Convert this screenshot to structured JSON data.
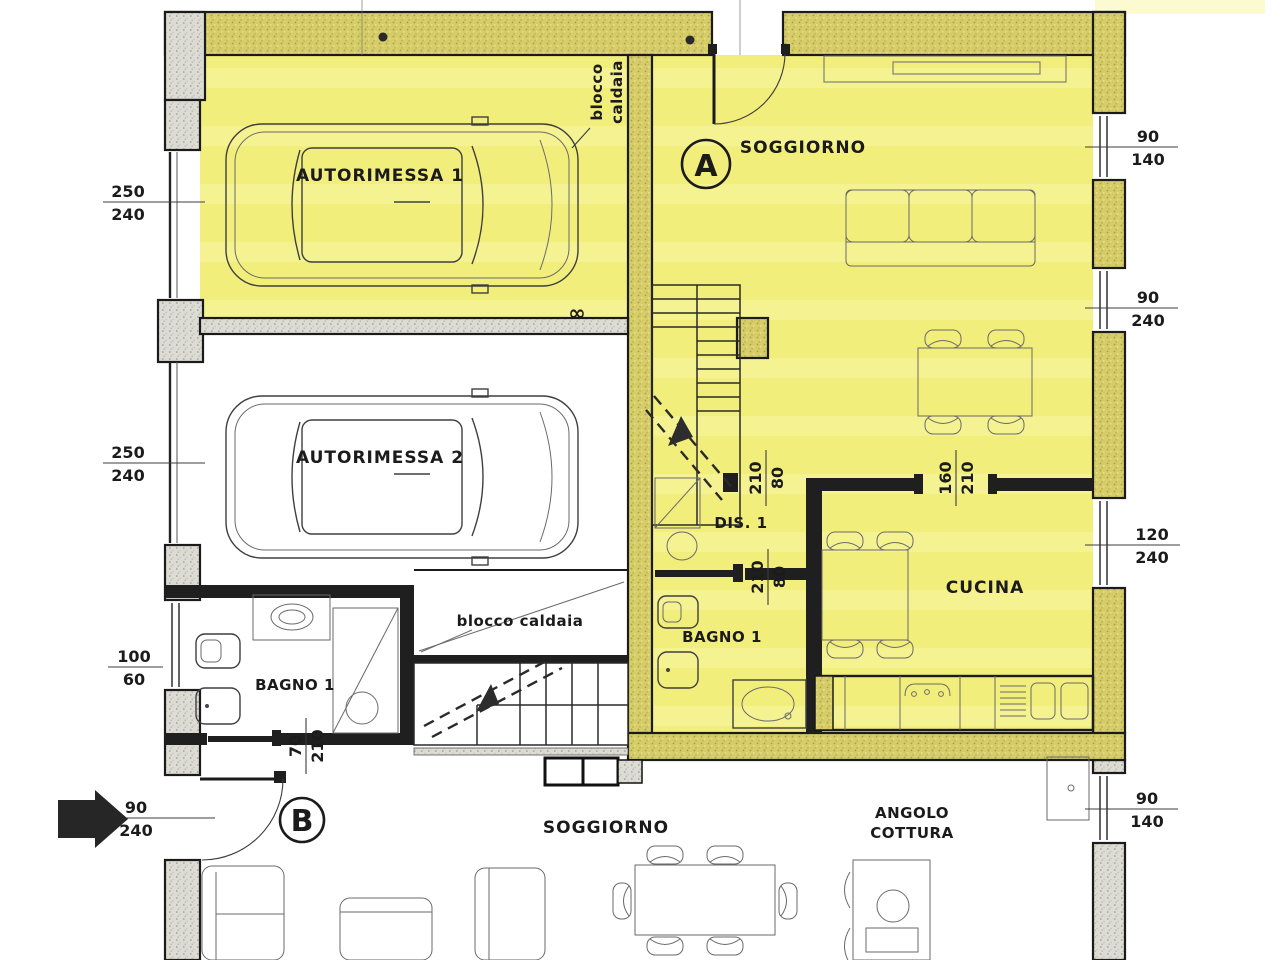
{
  "document": {
    "kind": "architectural-floor-plan",
    "language": "italian"
  },
  "colors": {
    "floor_highlight": "#f2ee7c",
    "floor_highlight_band": "#f8f5a3",
    "wall_hatch_yellow": "#d6cd69",
    "wall_hatch_gray": "#dcdbd4",
    "ink": "#1b1b1b",
    "paper": "#ffffff"
  },
  "badges": {
    "unit_a": "A",
    "unit_b": "B"
  },
  "labels": {
    "autorimessa1": "AUTORIMESSA 1",
    "autorimessa2": "AUTORIMESSA 2",
    "soggiorno_a": "SOGGIORNO",
    "blocco_caldaia_line1": "blocco",
    "blocco_caldaia_line2": "caldaia",
    "blocco_caldaia_mid": "blocco caldaia",
    "dis1": "DIS. 1",
    "cucina": "CUCINA",
    "bagno1_a": "BAGNO 1",
    "bagno1_b": "BAGNO 1",
    "soggiorno_b": "SOGGIORNO",
    "angolo_cottura_line1": "ANGOLO",
    "angolo_cottura_line2": "COTTURA",
    "infinity": "∞"
  },
  "dimensions": {
    "garage1_door": {
      "w": "250",
      "h": "240"
    },
    "garage2_door": {
      "w": "250",
      "h": "240"
    },
    "window_soggiorno_a1": {
      "w": "90",
      "h": "140"
    },
    "window_soggiorno_a2": {
      "w": "90",
      "h": "240"
    },
    "door_soggiorno_cucina": {
      "w": "160",
      "h": "210"
    },
    "door_dis1": {
      "w": "80",
      "h": "210"
    },
    "door_bagno_a": {
      "w": "80",
      "h": "210"
    },
    "window_cucina": {
      "w": "120",
      "h": "240"
    },
    "window_bagno_b": {
      "w": "100",
      "h": "60"
    },
    "door_bagno_b": {
      "w": "70",
      "h": "210"
    },
    "door_entrance_b": {
      "w": "90",
      "h": "240"
    },
    "window_soggiorno_b": {
      "w": "90",
      "h": "140"
    }
  }
}
